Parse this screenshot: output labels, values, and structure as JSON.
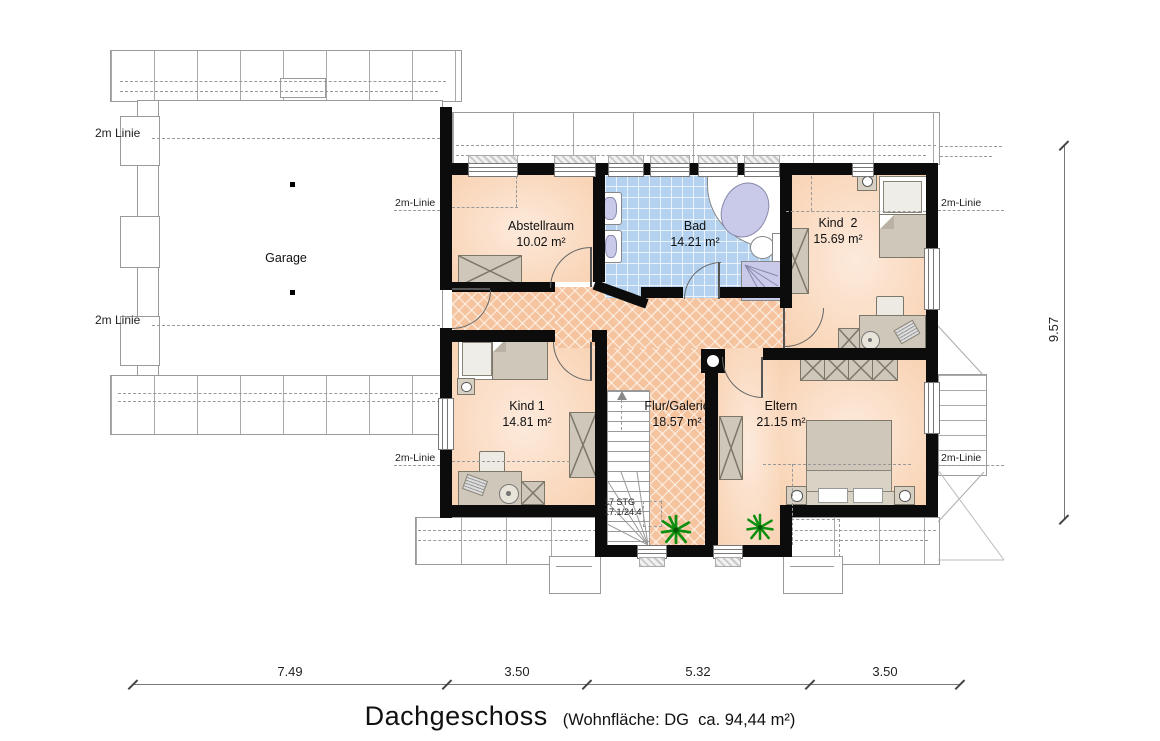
{
  "title": {
    "main": "Dachgeschoss",
    "sub": "(Wohnfläche: DG  ca. 94,44 m²)"
  },
  "rooms": {
    "garage": {
      "name": "Garage"
    },
    "abstellraum": {
      "name": "Abstellraum",
      "area": "10.02 m²"
    },
    "bad": {
      "name": "Bad",
      "area": "14.21 m²"
    },
    "kind2": {
      "name": "Kind  2",
      "area": "15.69 m²"
    },
    "kind1": {
      "name": "Kind 1",
      "area": "14.81 m²"
    },
    "flur": {
      "name": "Flur/Galerie",
      "area": "18.57 m²"
    },
    "eltern": {
      "name": "Eltern",
      "area": "21.15 m²"
    }
  },
  "stairs": {
    "steps": "17 STG",
    "ratio": "17.1/24.4"
  },
  "dimensions": {
    "bottom": [
      "7.49",
      "3.50",
      "5.32",
      "3.50"
    ],
    "right": "9.57"
  },
  "guides": {
    "garage_top": "2m Linie",
    "garage_bottom": "2m Linie",
    "house_left_top": "2m-Linie",
    "house_left_bottom": "2m-Linie",
    "house_right_top": "2m-Linie",
    "house_right_bottom": "2m-Linie"
  },
  "colors": {
    "wall": "#0c0c0c",
    "room_fill": "#f8d6bb",
    "hall_fill": "#f5c49e",
    "bath_fill": "#b4d2f0",
    "fixture": "#c9c9ea",
    "furniture": "#cfc8ba",
    "plant": "#0f8f0f"
  }
}
